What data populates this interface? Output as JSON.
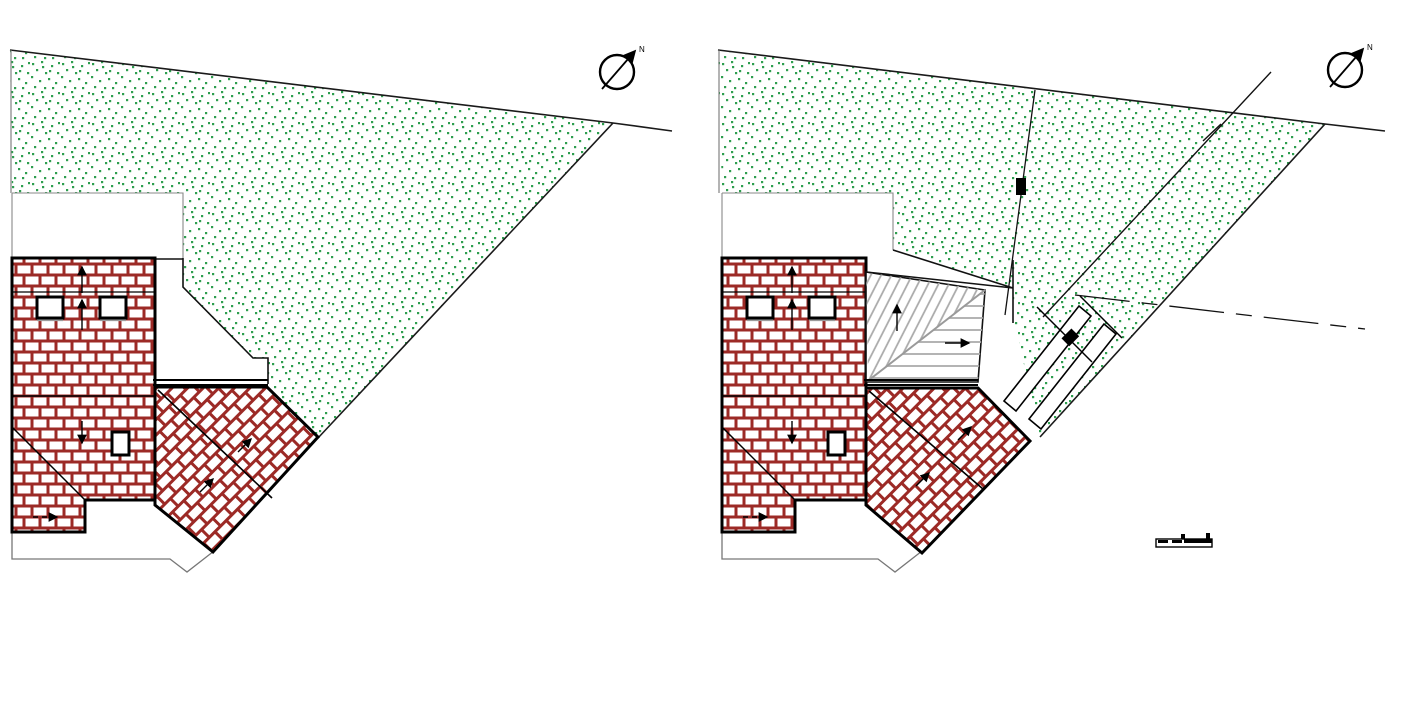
{
  "page": {
    "background": "#ffffff",
    "description": "Two architectural roof site plans side by side"
  },
  "colors": {
    "brick_mortar": "#9c2a26",
    "vegetation": "#2e9e4f",
    "outline": "#000000",
    "thin_line": "#777777",
    "roof_hatch": "#ababab",
    "roof_ridge": "#9a9a9a",
    "paper": "#ffffff"
  },
  "panels": {
    "left": {
      "name": "left-plan",
      "north_label": "N"
    },
    "right": {
      "name": "right-plan",
      "north_label": "N"
    }
  }
}
